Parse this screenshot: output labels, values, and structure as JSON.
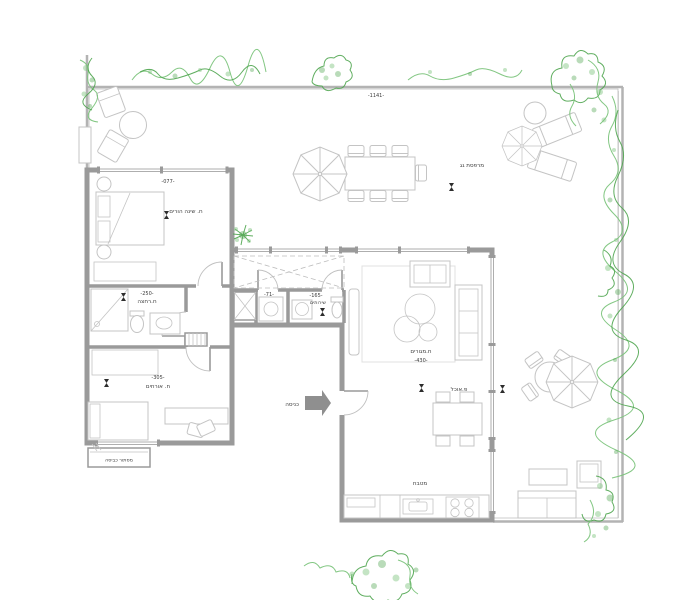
{
  "colors": {
    "wall": "#9a9a9a",
    "deck_line": "#dddddd",
    "deck_bg": "#f6f6f6",
    "furniture_line": "#c4c4c4",
    "plant_green": "#7cc47c",
    "plant_green_dark": "#4fa54f",
    "text": "#3c3c3c",
    "entrance_arrow": "#8f8f8f"
  },
  "plan": {
    "terrace": {
      "dimension": "-1141-",
      "label": "מרפסת גג"
    },
    "entrance_label": "כניסה",
    "laundry_label": "מסתור כביסה",
    "rooms": {
      "master_bedroom": {
        "code": "-077-",
        "name": "ח. שינה הורים"
      },
      "bathroom": {
        "code": "-250-",
        "name": "ח.רחצה"
      },
      "guest_room": {
        "code": "-305-",
        "name": "ח. אורחים"
      },
      "utility": {
        "code": "-71-"
      },
      "toilet": {
        "code": "-165-",
        "name": "שירותים"
      },
      "living_room": {
        "code": "-430-",
        "name": "ח.מגורים"
      },
      "dining": {
        "name": "פ.אוכל"
      },
      "kitchen": {
        "name": "מטבח"
      }
    }
  }
}
